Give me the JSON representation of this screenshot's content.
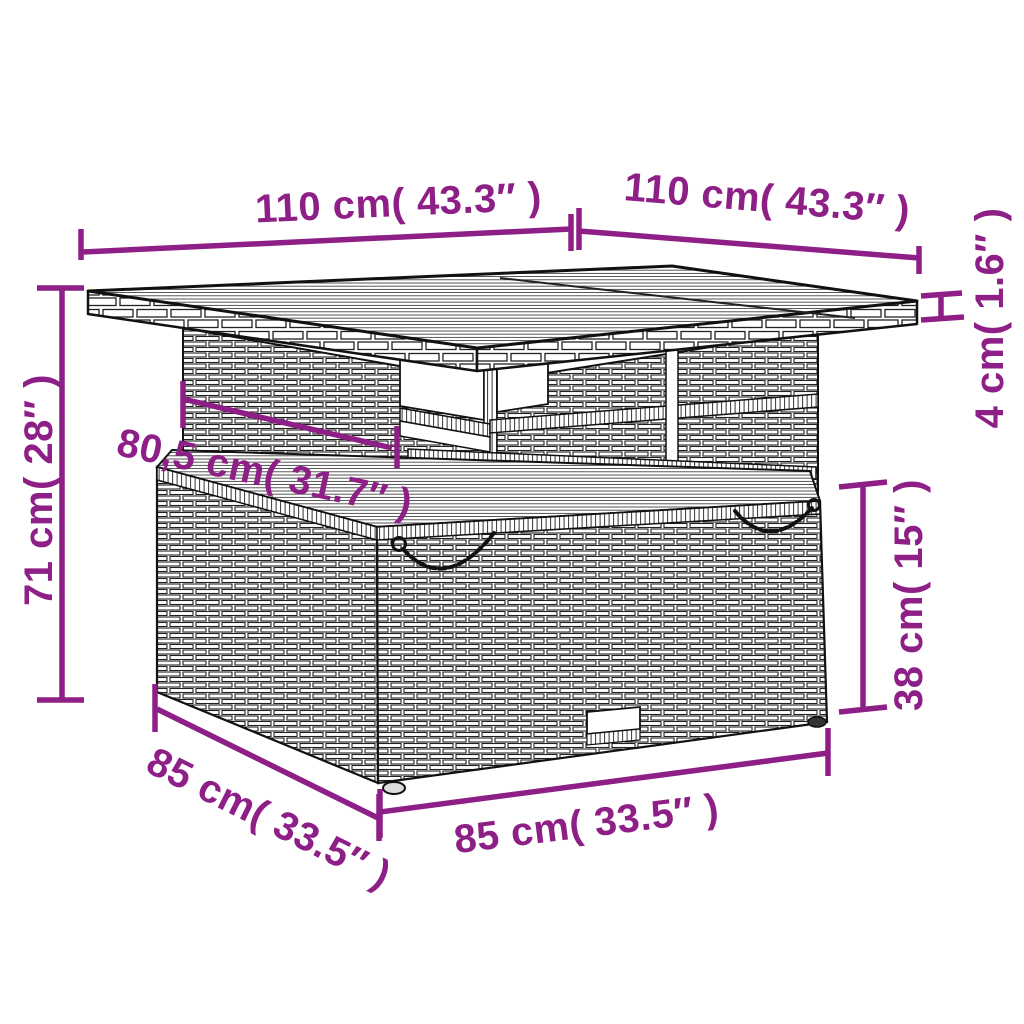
{
  "diagram": {
    "kind": "product-dimension-diagram",
    "subject": "rattan garden storage table",
    "colors": {
      "dimension_accent": "#8D1F87",
      "line_art": "#111111",
      "background": "#ffffff"
    },
    "dimensions": {
      "tabletop_width": {
        "label": "110 cm( 43.3″ )",
        "value_cm": 110,
        "value_in": 43.3
      },
      "tabletop_depth": {
        "label": "110 cm( 43.3″ )",
        "value_cm": 110,
        "value_in": 43.3
      },
      "tabletop_thickness": {
        "label": "4 cm( 1.6″ )",
        "value_cm": 4,
        "value_in": 1.6
      },
      "overall_height": {
        "label": "71 cm( 28″ )",
        "value_cm": 71,
        "value_in": 28
      },
      "inner_shelf_width": {
        "label": "80,5 cm( 31.7″ )",
        "value_cm": 80.5,
        "value_in": 31.7
      },
      "base_height": {
        "label": "38 cm( 15″ )",
        "value_cm": 38,
        "value_in": 15
      },
      "base_depth": {
        "label": "85 cm( 33.5″ )",
        "value_cm": 85,
        "value_in": 33.5
      },
      "base_width": {
        "label": "85 cm( 33.5″ )",
        "value_cm": 85,
        "value_in": 33.5
      }
    }
  }
}
